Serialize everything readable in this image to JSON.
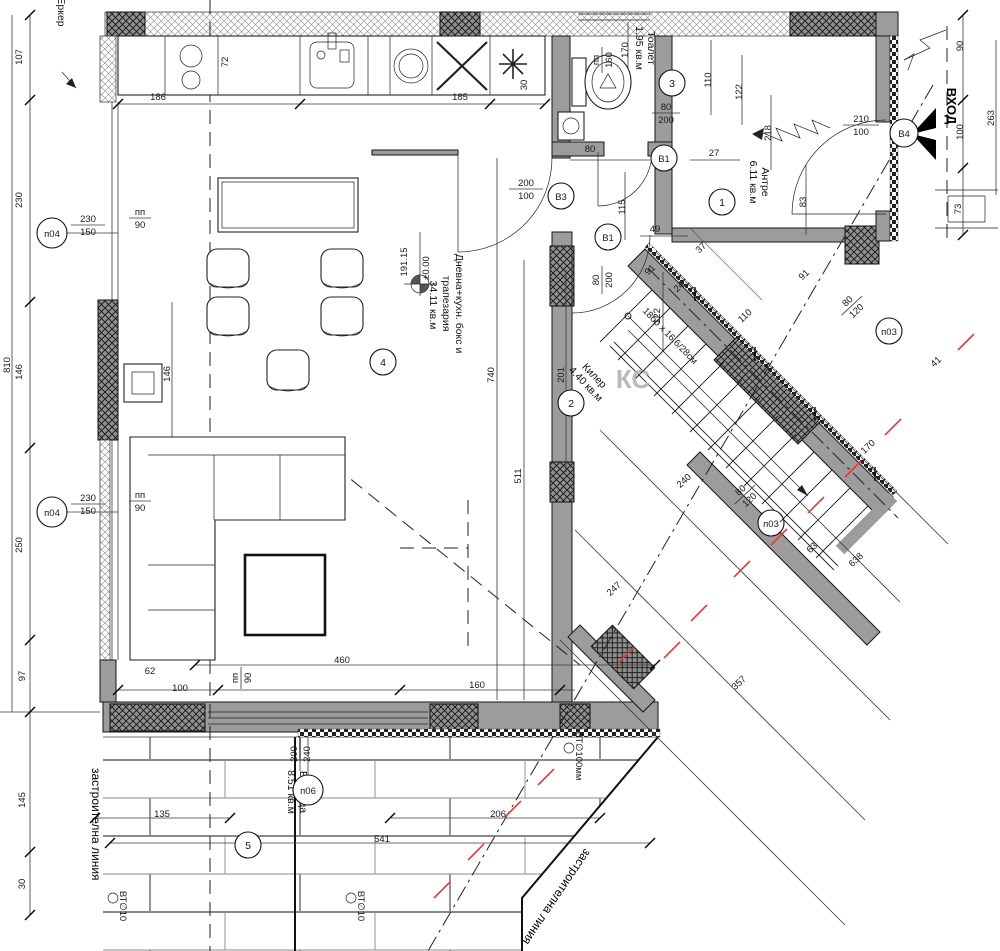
{
  "drawing": {
    "type": "architectural floor plan, ground floor",
    "language": "Bulgarian"
  },
  "colors": {
    "wall_gray": "#9c9c9c",
    "line_black": "#161616",
    "red_marks": "#d84040",
    "watermark_gray": "#b7bcb8"
  },
  "rooms": [
    {
      "number": "1",
      "name": "Антре",
      "area": "6.11 кв.м",
      "lines": [
        "Антре",
        "6.11 кв.м"
      ]
    },
    {
      "number": "2",
      "name": "Килер",
      "area": "4.40 кв.м",
      "lines": [
        "Килер",
        "4.40 кв.м"
      ]
    },
    {
      "number": "3",
      "name": "Тоалет",
      "area": "1.95 кв.м",
      "lines": [
        "Тоалет",
        "1.95 кв.м"
      ]
    },
    {
      "number": "4",
      "name": "Дневна+кухн. бокс и трапезария",
      "area": "34.11 кв.м",
      "lines": [
        "Дневна+кухн. бокс и",
        "трапезария",
        "34.11 кв.м"
      ]
    },
    {
      "number": "5",
      "name": "Веранда",
      "area": "8.51 кв.м",
      "lines": [
        "Веранда",
        "8.51 кв.м"
      ]
    }
  ],
  "markers": {
    "p04": {
      "code": "п04",
      "num": "230",
      "den": "150",
      "count": 2
    },
    "p06": {
      "code": "п06",
      "num": "200",
      "den": "240"
    },
    "p03": {
      "code": "п03",
      "num": "80",
      "den": "120",
      "count": 2
    },
    "B1": {
      "code": "В1",
      "num": "80",
      "den": "200",
      "count": 2
    },
    "B3": {
      "code": "В3",
      "num": "200",
      "den": "100"
    },
    "B4": {
      "code": "В4",
      "num": "210",
      "den": "100"
    },
    "pp90": {
      "code": "пп",
      "num": "пп",
      "den": "90",
      "count": 3
    },
    "pp160": {
      "code": "пп",
      "num": "пп",
      "den": "160"
    }
  },
  "texts": {
    "entrance": "ВХОД",
    "bay": "Еркер",
    "building_line": "застроителна линия",
    "building_line_diag": "застроителна линия",
    "stairs_note": "18бр x 16.6/28см",
    "pipe_large": "ВТ∅100мм",
    "pipe_small": "ВТ∅10",
    "level_abs": "191.15",
    "level_rel": "±0.00",
    "watermark": "КС"
  },
  "dims": [
    {
      "t": "810",
      "x": 10,
      "y": 365,
      "r": -90
    },
    {
      "t": "107",
      "x": 22,
      "y": 57,
      "r": -90
    },
    {
      "t": "230",
      "x": 22,
      "y": 200,
      "r": -90
    },
    {
      "t": "146",
      "x": 22,
      "y": 372,
      "r": -90
    },
    {
      "t": "250",
      "x": 22,
      "y": 545,
      "r": -90
    },
    {
      "t": "97",
      "x": 25,
      "y": 676,
      "r": -90
    },
    {
      "t": "145",
      "x": 25,
      "y": 800,
      "r": -90
    },
    {
      "t": "30",
      "x": 25,
      "y": 884,
      "r": -90
    },
    {
      "t": "186",
      "x": 158,
      "y": 100
    },
    {
      "t": "185",
      "x": 460,
      "y": 100
    },
    {
      "t": "72",
      "x": 228,
      "y": 62,
      "r": -90
    },
    {
      "t": "30",
      "x": 527,
      "y": 85,
      "r": -90
    },
    {
      "t": "170",
      "x": 628,
      "y": 50,
      "r": -90
    },
    {
      "t": "80",
      "x": 590,
      "y": 152
    },
    {
      "t": "110",
      "x": 711,
      "y": 80,
      "r": -90
    },
    {
      "t": "122",
      "x": 742,
      "y": 92,
      "r": -90
    },
    {
      "t": "27",
      "x": 714,
      "y": 156
    },
    {
      "t": "218",
      "x": 771,
      "y": 133,
      "r": -90
    },
    {
      "t": "83",
      "x": 806,
      "y": 202,
      "r": -90
    },
    {
      "t": "90",
      "x": 963,
      "y": 46,
      "r": -90
    },
    {
      "t": "263",
      "x": 994,
      "y": 118,
      "r": -90
    },
    {
      "t": "100",
      "x": 963,
      "y": 132,
      "r": -90
    },
    {
      "t": "73",
      "x": 961,
      "y": 209,
      "r": -90
    },
    {
      "t": "115",
      "x": 625,
      "y": 207,
      "r": -90
    },
    {
      "t": "49",
      "x": 655,
      "y": 232
    },
    {
      "t": "37",
      "x": 703,
      "y": 250,
      "r": -43
    },
    {
      "t": "91",
      "x": 652,
      "y": 272,
      "r": -43
    },
    {
      "t": "24",
      "x": 681,
      "y": 289,
      "r": -43
    },
    {
      "t": "110",
      "x": 747,
      "y": 318,
      "r": -43
    },
    {
      "t": "91",
      "x": 806,
      "y": 277,
      "r": -43
    },
    {
      "t": "740",
      "x": 494,
      "y": 375,
      "r": -90
    },
    {
      "t": "201",
      "x": 564,
      "y": 375,
      "r": -90
    },
    {
      "t": "146",
      "x": 170,
      "y": 374,
      "r": -90
    },
    {
      "t": "511",
      "x": 521,
      "y": 476,
      "r": -90
    },
    {
      "t": "122",
      "x": 660,
      "y": 316,
      "r": -90
    },
    {
      "t": "240",
      "x": 686,
      "y": 483,
      "r": -43
    },
    {
      "t": "41",
      "x": 938,
      "y": 364,
      "r": -43
    },
    {
      "t": "170",
      "x": 870,
      "y": 449,
      "r": -43
    },
    {
      "t": "63",
      "x": 814,
      "y": 550,
      "r": -43
    },
    {
      "t": "638",
      "x": 858,
      "y": 562,
      "r": -43
    },
    {
      "t": "247",
      "x": 616,
      "y": 591,
      "r": -43
    },
    {
      "t": "357",
      "x": 741,
      "y": 685,
      "r": -43
    },
    {
      "t": "62",
      "x": 150,
      "y": 674
    },
    {
      "t": "100",
      "x": 180,
      "y": 691
    },
    {
      "t": "460",
      "x": 342,
      "y": 663
    },
    {
      "t": "160",
      "x": 477,
      "y": 688
    },
    {
      "t": "135",
      "x": 162,
      "y": 817
    },
    {
      "t": "206",
      "x": 498,
      "y": 817
    },
    {
      "t": "541",
      "x": 382,
      "y": 842
    }
  ],
  "red_dashes": [
    {
      "x": 966,
      "y": 342
    },
    {
      "x": 893,
      "y": 427
    },
    {
      "x": 853,
      "y": 469
    },
    {
      "x": 816,
      "y": 505
    },
    {
      "x": 779,
      "y": 537
    },
    {
      "x": 742,
      "y": 569
    },
    {
      "x": 699,
      "y": 613
    },
    {
      "x": 672,
      "y": 650
    },
    {
      "x": 626,
      "y": 655
    },
    {
      "x": 546,
      "y": 777
    },
    {
      "x": 513,
      "y": 809
    },
    {
      "x": 476,
      "y": 852
    },
    {
      "x": 442,
      "y": 890
    }
  ],
  "stairs": {
    "note": "18бр x 16.6/28см",
    "steps_total": "18",
    "step_size": "16.6/28 см"
  }
}
